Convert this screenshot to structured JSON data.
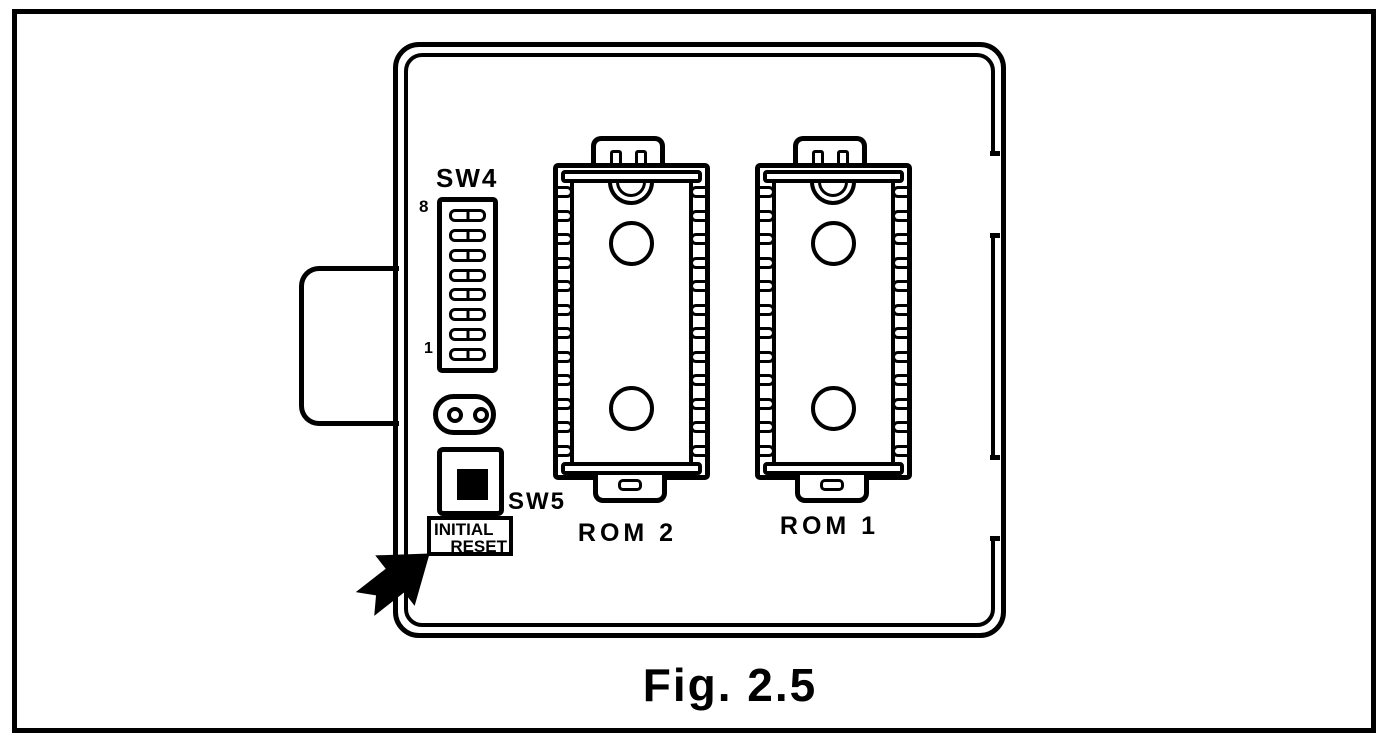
{
  "figure": {
    "caption": "Fig. 2.5"
  },
  "board": {
    "sw4": {
      "label": "SW4",
      "top_position_label": "8",
      "bottom_position_label": "1",
      "positions": 8
    },
    "sw5": {
      "label": "SW5",
      "button_label_line1": "INITIAL",
      "button_label_line2": "RESET"
    },
    "sockets": {
      "pins_per_side": 12,
      "rom2": {
        "label": "ROM 2"
      },
      "rom1": {
        "label": "ROM 1"
      }
    }
  },
  "colors": {
    "ink": "#000000",
    "paper": "#ffffff"
  }
}
